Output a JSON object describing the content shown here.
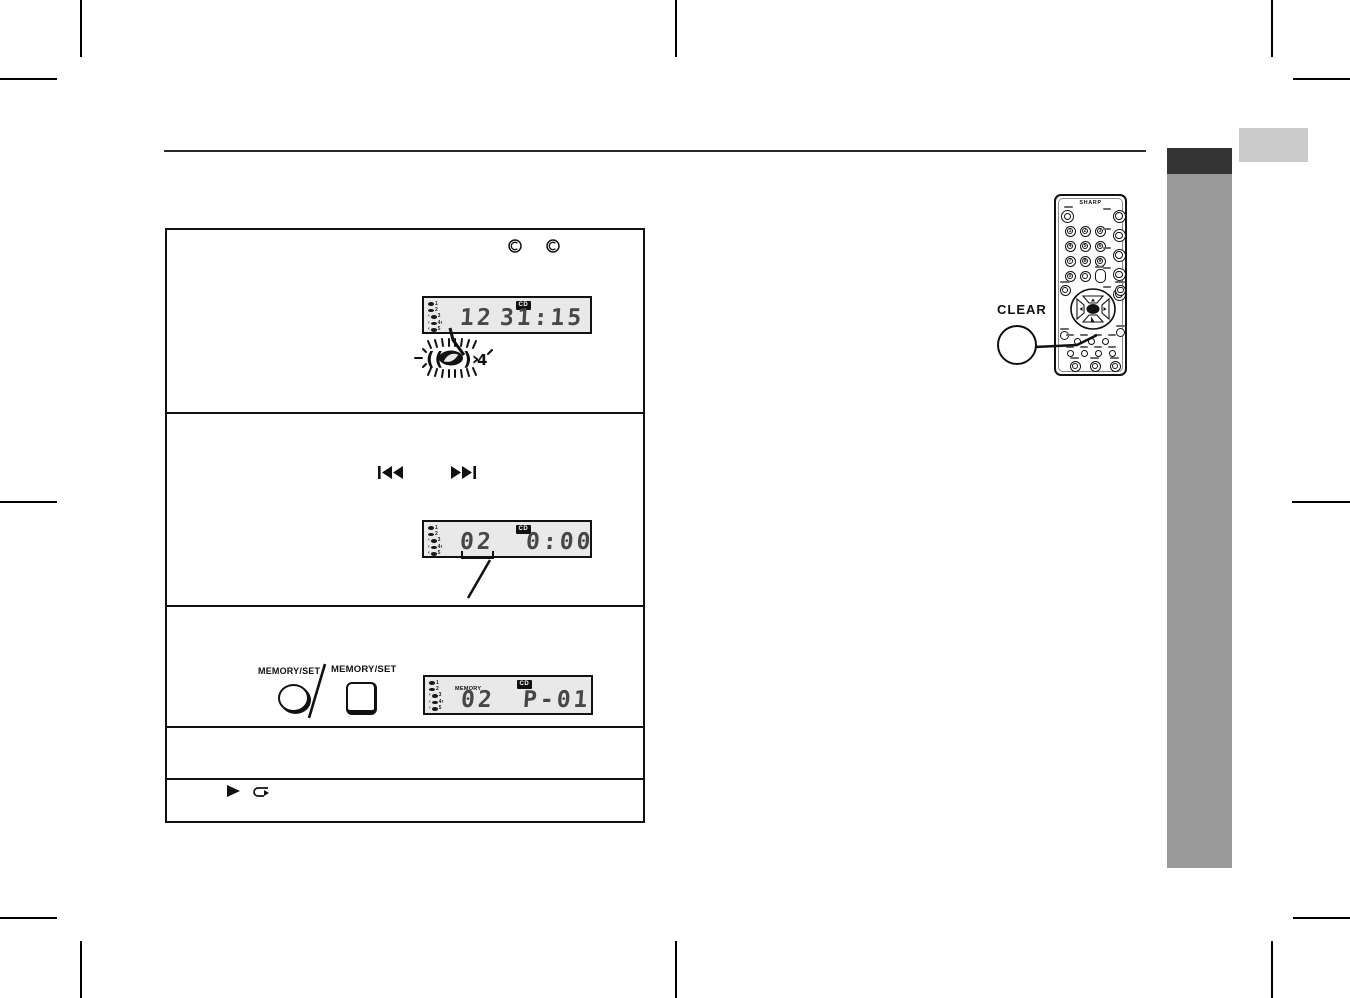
{
  "lcd_common": {
    "disc_numbers": [
      "1",
      "2",
      "3",
      "4",
      "5"
    ]
  },
  "panel": {
    "lcd1": {
      "cd_badge": "CD",
      "track": "12",
      "time": "31:15",
      "flashing_disc": "4"
    },
    "lcd2": {
      "cd_badge": "CD",
      "track": "02",
      "time": "0:00"
    },
    "lcd3": {
      "cd_badge": "CD",
      "memory_label": "MEMORY",
      "track": "02",
      "program": "P-01"
    },
    "memory_set_round_label": "MEMORY/SET",
    "memory_set_square_label": "MEMORY/SET"
  },
  "remote": {
    "brand": "SHARP",
    "clear_label": "CLEAR",
    "digits": [
      "1",
      "2",
      "3",
      "4",
      "5",
      "6",
      "7",
      "8",
      "9",
      "0"
    ]
  },
  "colors": {
    "sidebar_gray": "#999999",
    "sidebar_dark": "#333333",
    "tab_light": "#cbcbcb",
    "lcd_background": "#e9e9e9",
    "segment_digits": "#474747"
  }
}
